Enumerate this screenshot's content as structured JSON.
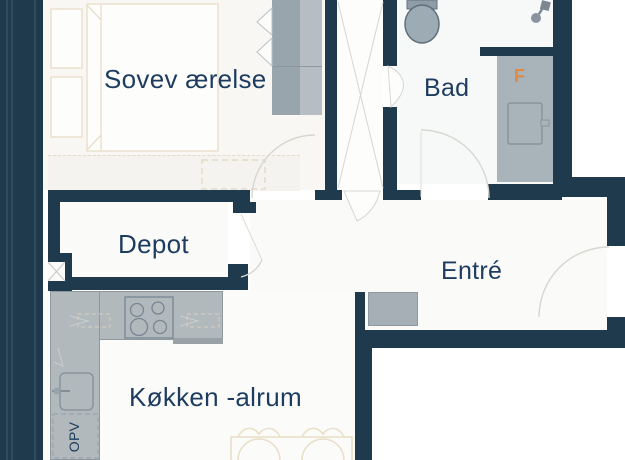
{
  "plan": {
    "rooms": [
      {
        "name": "bedroom",
        "label": "Sovev ærelse"
      },
      {
        "name": "bathroom",
        "label": "Bad"
      },
      {
        "name": "storage",
        "label": "Depot"
      },
      {
        "name": "entrance",
        "label": "Entré"
      },
      {
        "name": "kitchen_living",
        "label": "Køkken -alrum"
      }
    ],
    "annotations": {
      "dishwasher": "OPV",
      "shower_fitting": "F"
    },
    "colors": {
      "wall": "#1f3a4c",
      "label_text": "#1d3c5f",
      "fixture_gray": "#a9b3ba",
      "counter_gray": "#b2b9bd",
      "wardrobe_gray_dark": "#98a5ac",
      "wardrobe_gray_light": "#b6bec3",
      "furniture_outline_beige": "#e9dfcd",
      "accent_orange": "#dd8a47"
    }
  }
}
